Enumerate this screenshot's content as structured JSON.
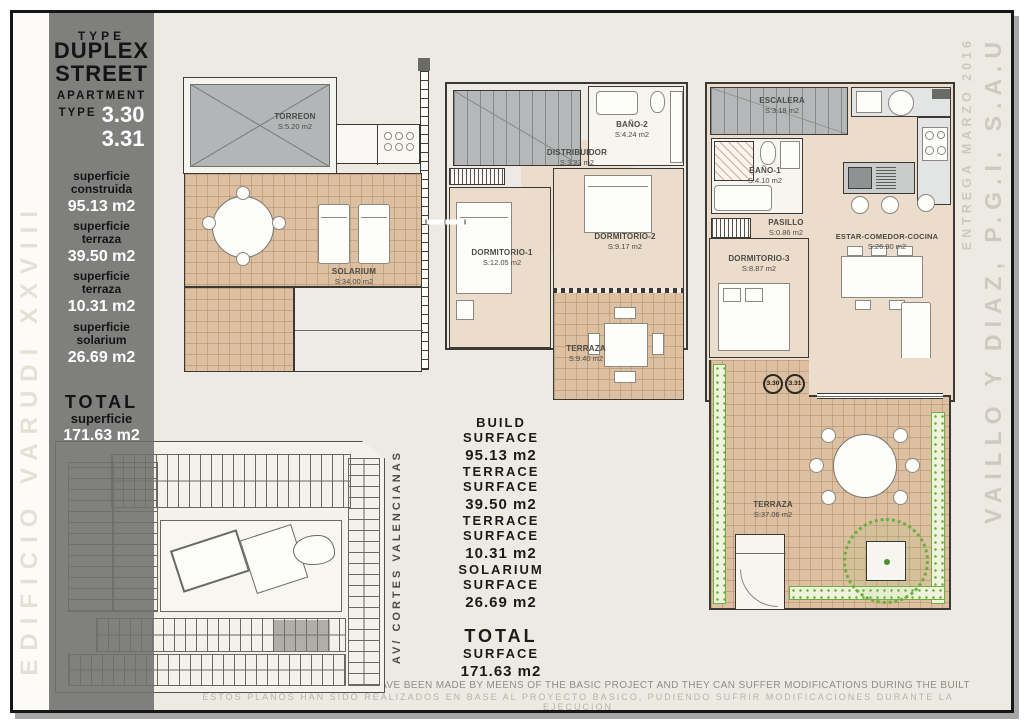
{
  "sheet": {
    "edge_title": "EDIFICIO VARUDI XXVIII",
    "right_title_main": "VAILLO Y DIAZ, P.G.I. S.A.U",
    "right_title_date": "ENTREGA MARZO 2016",
    "street_label": "AV/ CORTES VALENCIANAS",
    "disclaimer_en": "THESE PLANS HAVE BEEN MADE BY MEENS OF THE BASIC PROJECT AND THEY CAN SUFFER MODIFICATIONS DURING THE BUILT",
    "disclaimer_es": "ESTOS PLANOS HAN SIDO REALIZADOS EN BASE AL PROYECTO BASICO, PUDIENDO SUFRIR MODIFICACIONES DURANTE LA EJECUCION"
  },
  "info_panel": {
    "type_label": "TYPE",
    "type_line1": "DUPLEX",
    "type_line2": "STREET",
    "apartment_label": "APARTMENT",
    "apartment_type_label": "TYPE",
    "apartment_numbers": [
      "3.30",
      "3.31"
    ],
    "surfaces": [
      {
        "label_line1": "superficie",
        "label_line2": "construida",
        "value": "95.13 m2"
      },
      {
        "label_line1": "superficie",
        "label_line2": "terraza",
        "value": "39.50 m2"
      },
      {
        "label_line1": "superficie",
        "label_line2": "terraza",
        "value": "10.31 m2"
      },
      {
        "label_line1": "superficie",
        "label_line2": "solarium",
        "value": "26.69 m2"
      }
    ],
    "total_label": "TOTAL",
    "total_sublabel": "superficie",
    "total_value": "171.63 m2"
  },
  "surface_summary": {
    "items": [
      {
        "line1": "BUILD",
        "line2": "SURFACE",
        "value": "95.13 m2"
      },
      {
        "line1": "TERRACE",
        "line2": "SURFACE",
        "value": "39.50 m2"
      },
      {
        "line1": "TERRACE",
        "line2": "SURFACE",
        "value": "10.31 m2"
      },
      {
        "line1": "SOLARIUM",
        "line2": "SURFACE",
        "value": "26.69 m2"
      }
    ],
    "total": {
      "line1": "TOTAL",
      "line2": "SURFACE",
      "value": "171.63 m2"
    }
  },
  "plans": {
    "solarium_floor": {
      "rooms": {
        "torreon": {
          "name": "TORREON",
          "area": "S:5.20 m2"
        },
        "solarium": {
          "name": "SOLARIUM",
          "area": "S:34.00 m2"
        }
      }
    },
    "first_floor": {
      "rooms": {
        "distribuidor": {
          "name": "DISTRIBUIDOR",
          "area": "S:3.23 m2"
        },
        "bano2": {
          "name": "BAÑO-2",
          "area": "S:4.24 m2"
        },
        "dormitorio1": {
          "name": "DORMITORIO-1",
          "area": "S:12.05 m2"
        },
        "dormitorio2": {
          "name": "DORMITORIO-2",
          "area": "S:9.17 m2"
        },
        "terraza": {
          "name": "TERRAZA",
          "area": "S:9.40 m2"
        }
      }
    },
    "ground_floor": {
      "rooms": {
        "escalera": {
          "name": "ESCALERA",
          "area": "S:3.18 m2"
        },
        "bano1": {
          "name": "BAÑO-1",
          "area": "S:4.10 m2"
        },
        "pasillo": {
          "name": "PASILLO",
          "area": "S:0.86 m2"
        },
        "dormitorio3": {
          "name": "DORMITORIO-3",
          "area": "S:8.87 m2"
        },
        "estar": {
          "name": "ESTAR-COMEDOR-COCINA",
          "area": "S:26.90 m2"
        },
        "terraza": {
          "name": "TERRAZA",
          "area": "S:37.06 m2"
        }
      },
      "unit_badges": [
        "3.30",
        "3.31"
      ]
    }
  },
  "colors": {
    "panel_gray": "#8a8a8a",
    "tile_tan": "#ddc0a1",
    "interior_beige": "#ecdccb",
    "hedge_green": "#6fae3e",
    "roof_gray": "#b3b6b7"
  }
}
